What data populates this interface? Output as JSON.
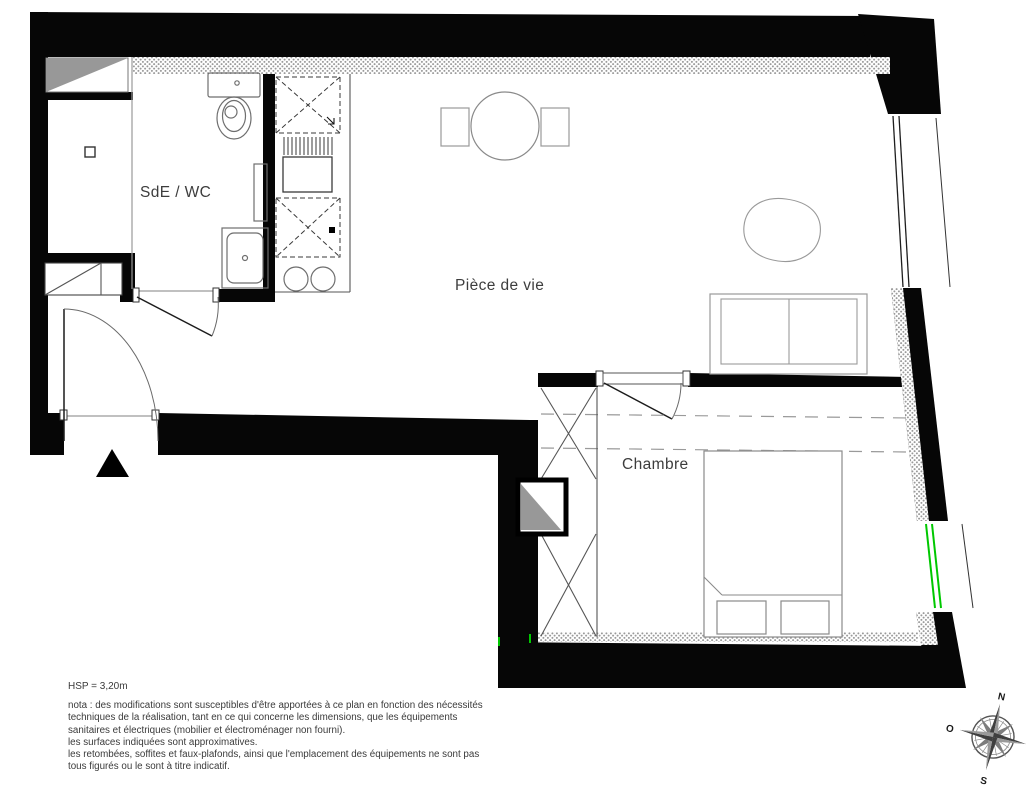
{
  "rooms": {
    "bathroom": {
      "label": "SdE / WC"
    },
    "living": {
      "label": "Pièce de vie"
    },
    "bedroom": {
      "label": "Chambre"
    }
  },
  "notes": {
    "hsp": "HSP = 3,20m",
    "lines": [
      "nota : des modifications sont susceptibles d'être apportées à ce plan en fonction des nécessités",
      "techniques de la réalisation, tant en ce qui concerne les dimensions, que les équipements",
      "sanitaires et électriques (mobilier et électroménager non fourni).",
      "les surfaces indiquées sont approximatives.",
      "les retombées, soffites et faux-plafonds, ainsi que l'emplacement des équipements ne sont pas",
      "tous figurés ou le sont à titre indicatif."
    ]
  },
  "compass": {
    "north": "N",
    "south": "S",
    "east": "E",
    "west": "O"
  },
  "colors": {
    "wall": "#060606",
    "window_green": "#00c800",
    "hatch_dot": "#9a9a9a",
    "furniture_line": "#6e6e6e",
    "gray_fill": "#989898"
  },
  "fixtures": {
    "bathroom": [
      "toilet-with-cistern",
      "shower-tray",
      "towel-radiator"
    ],
    "kitchen": [
      "appliance-space-dashed",
      "sink-with-drainer",
      "appliance-space-dashed",
      "two-burner-hob"
    ],
    "living": [
      "round-dining-table",
      "two-chairs",
      "pouf-rug",
      "two-seat-sofa"
    ],
    "bedroom": [
      "wardrobe-cross",
      "technical-shaft",
      "double-bed-with-pillows"
    ],
    "entry": [
      "entrance-arrow",
      "door-swing"
    ]
  }
}
